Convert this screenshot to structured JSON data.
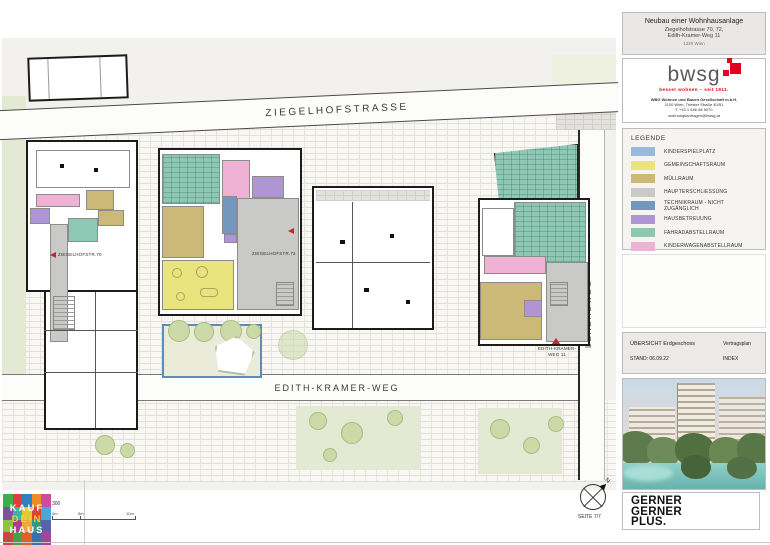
{
  "sheet": {
    "project_line1": "Neubau einer Wohnhausanlage",
    "project_line2": "Ziegelhofstrasse 70, 72,",
    "project_line3": "Edith-Kramer-Weg 11",
    "project_line4": "1220 Wien"
  },
  "client": {
    "logo_text": "bwsg",
    "tagline": "besser wohnen – seit 1911.",
    "brand_red": "#e2001a",
    "address_line1": "WBG Wohnen und Bauen Gesellschaft m.b.H.",
    "address_line2": "1100 Wien, Triester Straße 40/51",
    "address_line3": "T +43 1 546 08 5070",
    "address_line4": "wohnungsanfragen@bwsg.at"
  },
  "legend": {
    "title": "LEGENDE",
    "items": [
      {
        "label": "KINDERSPIELPLATZ",
        "color": "#9ab9dc"
      },
      {
        "label": "GEMEINSCHAFTSRAUM",
        "color": "#e9e47d"
      },
      {
        "label": "MÜLLRAUM",
        "color": "#cdb977"
      },
      {
        "label": "HAUPTERSCHLIESSUNG",
        "color": "#c9c9c7"
      },
      {
        "label": "TECHNIKRAUM - NICHT ZUGÄNGLICH",
        "color": "#7497bd"
      },
      {
        "label": "HAUSBETREUUNG",
        "color": "#b095d5"
      },
      {
        "label": "FAHRADABSTELLRAUM",
        "color": "#8fc7b5"
      },
      {
        "label": "KINDERWAGENABSTELLRAUM",
        "color": "#efb2d4"
      }
    ]
  },
  "info": {
    "plan_name": "ÜBERSICHT Erdgeschoss",
    "stand": "STAND: 06.09.22",
    "plan_type": "Vertragsplan",
    "index": "INDEX"
  },
  "plan": {
    "street_top": "ZIEGELHOFSTRASSE",
    "street_bottom": "EDITH-KRAMER-WEG",
    "street_right": "LEHERBWEG",
    "label_building_left": "ZIEGELHOFSTR.70",
    "label_building_mid": "ZIEGELHOFSTR.72",
    "label_building_right_line1": "EDITH-KRAMER-",
    "label_building_right_line2": "WEG 11",
    "marker_red": "#c1272d",
    "playground_border": "#5b8db8"
  },
  "scale": {
    "ratio": "300",
    "mark0": "0m",
    "mark1": "5m",
    "mark2": "10m"
  },
  "north": {
    "label": "N"
  },
  "page": {
    "seite": "SEITE 7/7"
  },
  "architect": {
    "line1": "GERNER",
    "line2": "GERNER",
    "line3": "PLUS."
  },
  "kaufdeinhaus": {
    "line1": "KAUF",
    "line2": "DEIN",
    "line3": "HAUS",
    "colors": [
      "#3fae49",
      "#e23c3c",
      "#2f7fc1",
      "#f08a24",
      "#c94f9e",
      "#7b52a0",
      "#39b5a5",
      "#e6c832",
      "#d8482f",
      "#4aa8d8",
      "#8bc53f",
      "#b03a8c",
      "#f0a83c",
      "#35968c",
      "#5a62a8",
      "#cc4444",
      "#4a9e4a",
      "#d86428",
      "#3a6fb0",
      "#a04898"
    ]
  }
}
